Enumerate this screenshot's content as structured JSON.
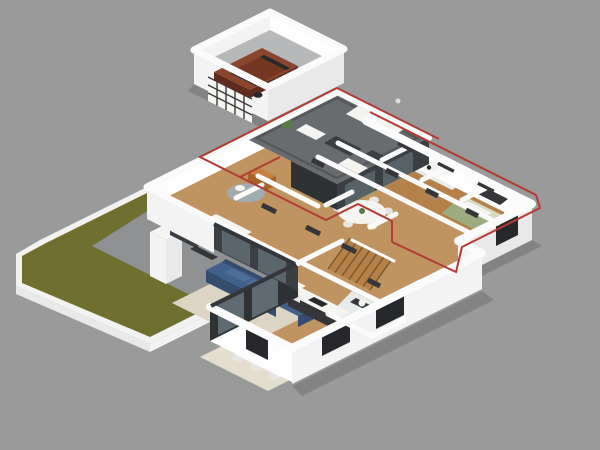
{
  "scene": {
    "type": "3d-isometric-floor-plan-render",
    "description": "Top-down axonometric 3D rendering of a single-story house floor plan on a plain gray background. No text labels are visible; a thin red outline annotates the upper-floor footprint over the terrace, study and the north-east bedroom wing.",
    "annotation": "red upper-floor footprint outline",
    "annotation_color": "#b23b34"
  },
  "palette": {
    "bg": "#9a9a9a",
    "curb": "#f2f2f0",
    "lawn": "#6f7030",
    "patio": "#8f9193",
    "concrete": "#b7b8ba",
    "wood": "#c09460",
    "wood-dark": "#b5814b",
    "wood-line": "#7e5428",
    "deck": "#686c6f",
    "glass-dark": "#2e3235",
    "glass-dark-2": "#3a3f43",
    "glass-pane": "#8fa3ab",
    "wall-top": "#fbfbfb",
    "wall-face": "#f3f3f3",
    "wall-face-2": "#e9e9e9",
    "wall-face-3": "#fdfdfd",
    "frame-dark": "#34363a",
    "furniture-white": "#f5f4f1",
    "furniture-white-2": "#e7e5e0",
    "rug": "#ddd5c4",
    "rug-light": "#e4decf",
    "rug-gray": "#a2abb0",
    "sofa-blue": "#41608a",
    "sofa-blue-dark": "#344d6e",
    "sofa-blue-light": "#4e6d99",
    "blanket-gray": "#9aa0a6",
    "armchair-orange": "#c9803f",
    "armchair-orange-dark": "#a86228",
    "bed-green": "#d7dac2",
    "bed-green-dark": "#9dab80",
    "car-body": "#8a452e",
    "car-body-dark": "#733722",
    "car-side": "#5e2b1d",
    "car-window": "#26282c",
    "tile": "#e8ebeb",
    "plant-green": "#5a7a4a",
    "annotation-red": "#b23b34"
  },
  "objects": {
    "outdoor": [
      "lawn",
      "patio",
      "chimney-block"
    ],
    "garage": [
      "suv-car",
      "sectional-garage-door"
    ],
    "terrace": [
      "outdoor-sofa",
      "outdoor-loveseat",
      "outdoor-armchair",
      "coffee-table",
      "potted-plant",
      "glass-parapet"
    ],
    "study": [
      "orange-armchair",
      "round-rug",
      "side-table"
    ],
    "west_bedroom": [
      "double-bed",
      "wardrobe",
      "tv-console"
    ],
    "living_room": [
      "blue-sectional-sofa",
      "round-coffee-tables",
      "area-rug"
    ],
    "dining_room": [
      "dining-table",
      "six-chairs",
      "area-rug"
    ],
    "kitchen": [
      "counter-run",
      "cooktop",
      "tall-cabinet"
    ],
    "breakfast_nook": [
      "oval-table",
      "chairs"
    ],
    "hallway": [
      "staircase"
    ],
    "ne_wing": [
      "tv-dresser",
      "dresser",
      "bathroom-fixtures",
      "closet"
    ],
    "east_bedroom": [
      "double-bed",
      "nightstand",
      "potted-plant",
      "pencil-markup"
    ]
  }
}
